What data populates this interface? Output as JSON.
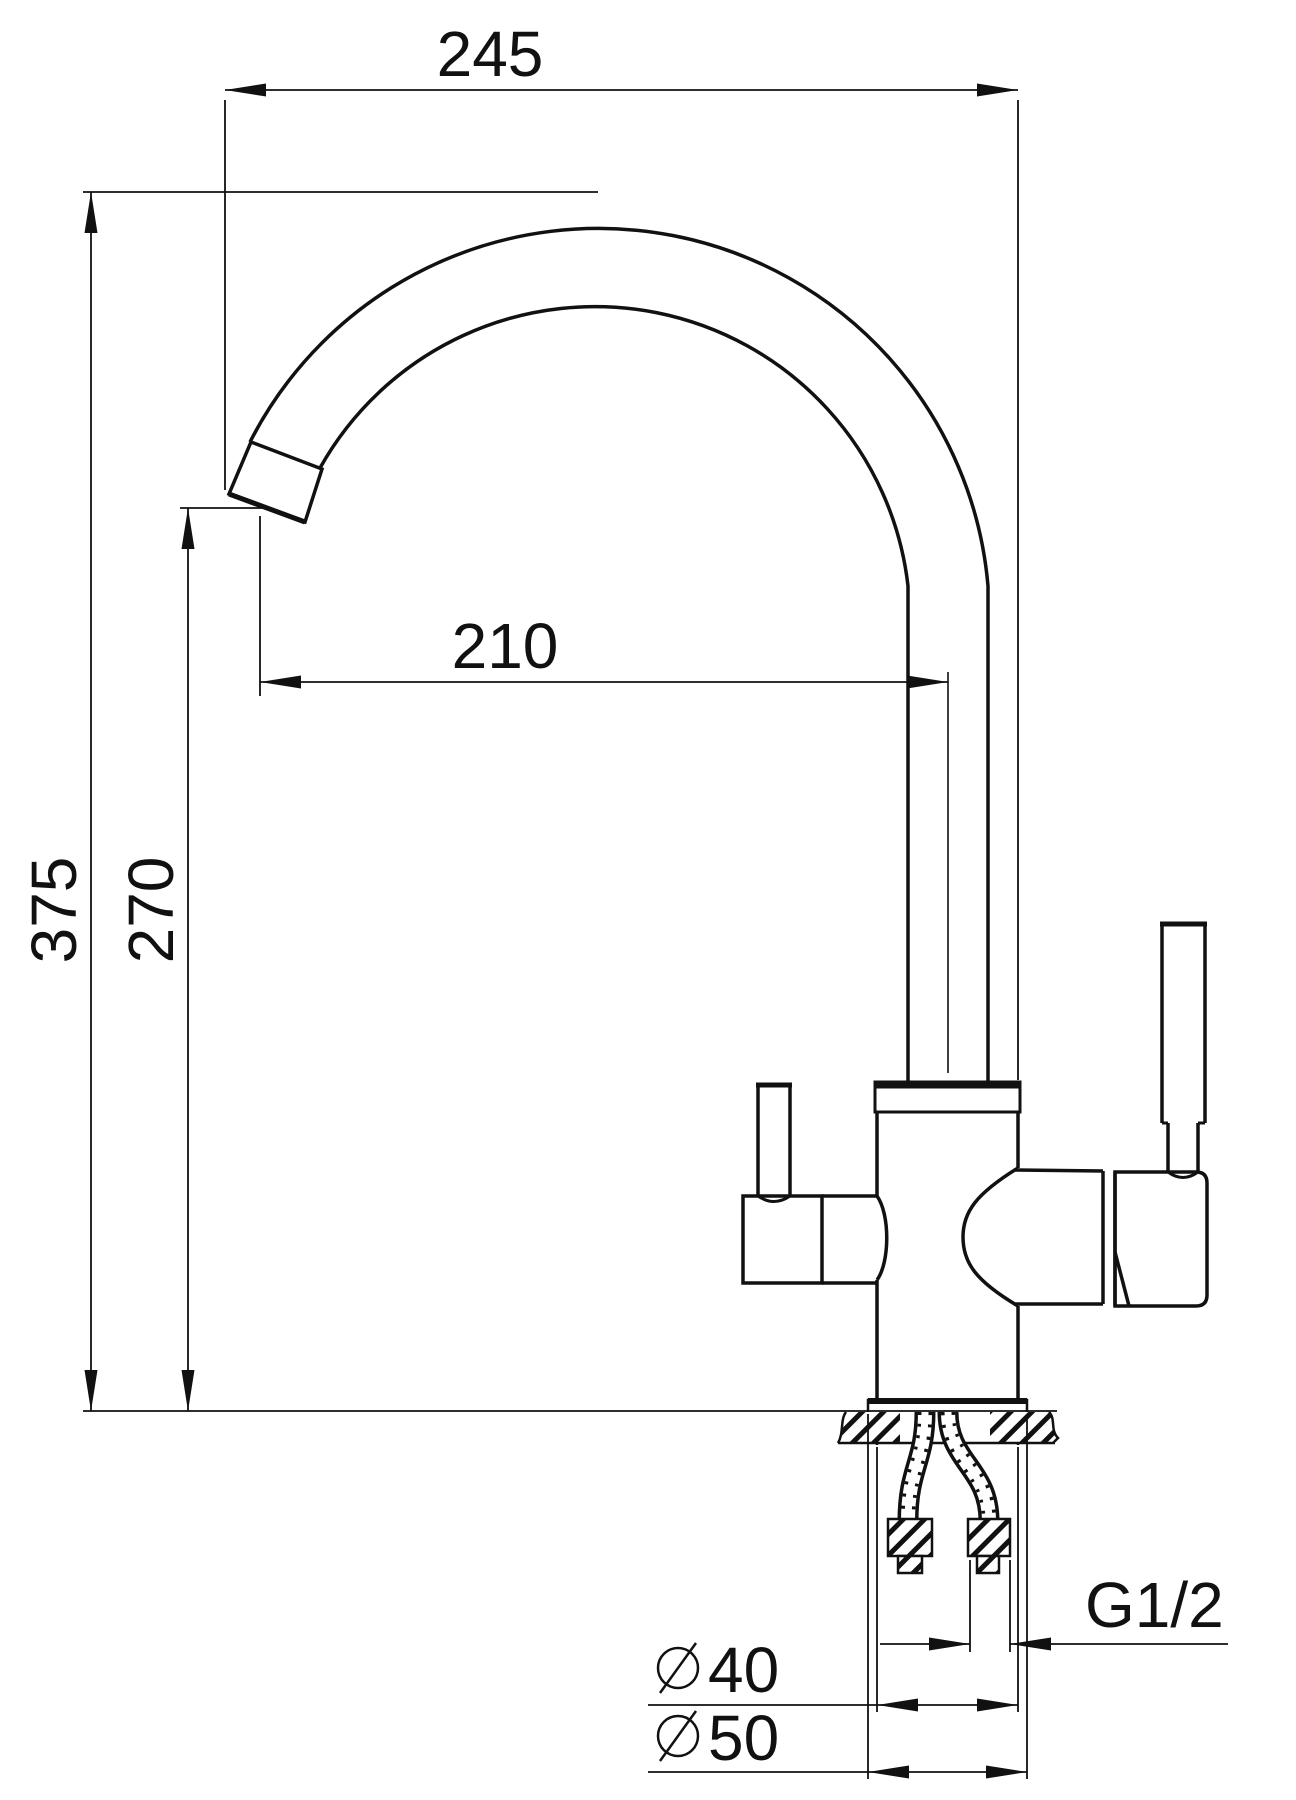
{
  "drawing": {
    "background": "#ffffff",
    "line_color": "#111111",
    "dimensions": {
      "overall_width": "245",
      "spout_reach": "210",
      "overall_height": "375",
      "spout_outlet_height": "270",
      "connection_thread": "G1/2",
      "body_diameter": "40",
      "base_diameter": "50"
    }
  }
}
